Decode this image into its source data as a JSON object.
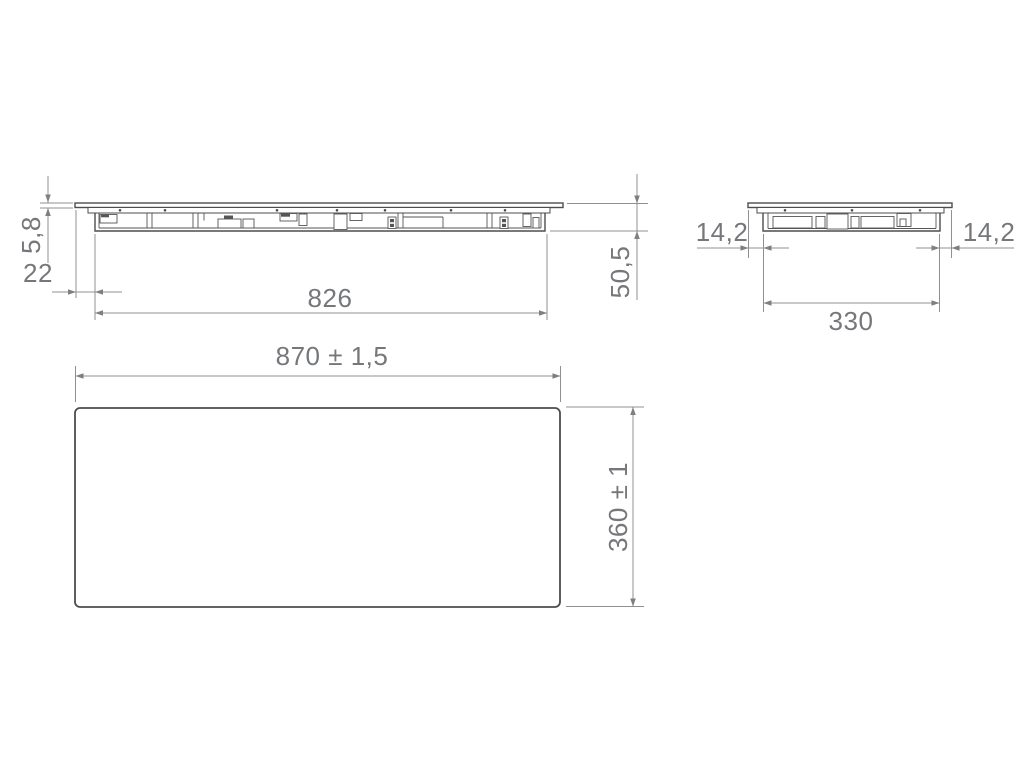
{
  "drawing": {
    "type": "appliance installation dimension drawing",
    "views": {
      "front": {
        "name": "front-elevation",
        "dims": {
          "glass_thickness": "5,8",
          "left_offset": "22",
          "body_width": "826",
          "total_height": "50,5"
        }
      },
      "side": {
        "name": "side-elevation",
        "dims": {
          "left_overhang": "14,2",
          "right_overhang": "14,2",
          "body_depth": "330"
        }
      },
      "top": {
        "name": "top-plan",
        "dims": {
          "overall_width": "870 ± 1,5",
          "overall_depth": "360 ± 1"
        }
      }
    },
    "colors": {
      "background": "#ffffff",
      "object_line": "#4d4d4d",
      "dimension_line": "#909090",
      "dimension_text": "#75777a"
    }
  }
}
